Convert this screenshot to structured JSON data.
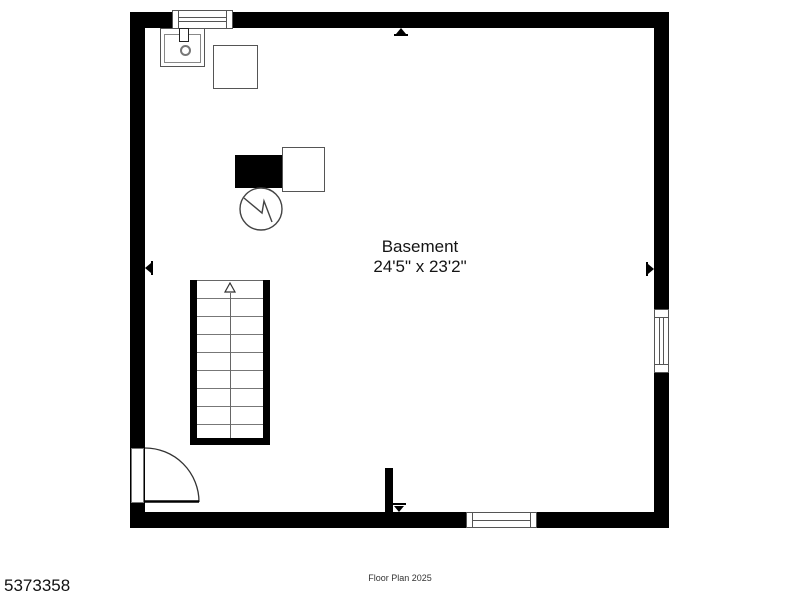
{
  "room": {
    "name": "Basement",
    "dimensions": "24'5\" x 23'2\""
  },
  "footer": {
    "listing_id": "5373358",
    "caption": "Floor Plan 2025"
  },
  "colors": {
    "wall": "#000000",
    "fixture_outline": "#555555",
    "tread_line": "#777777",
    "text": "#141414",
    "background": "#ffffff"
  },
  "fixtures": [
    {
      "name": "top-window"
    },
    {
      "name": "sink"
    },
    {
      "name": "storage-box"
    },
    {
      "name": "furnace"
    },
    {
      "name": "utility-box"
    },
    {
      "name": "water-heater"
    },
    {
      "name": "staircase-up"
    },
    {
      "name": "entry-door"
    },
    {
      "name": "wall-stub"
    },
    {
      "name": "right-window"
    },
    {
      "name": "bottom-window"
    }
  ]
}
